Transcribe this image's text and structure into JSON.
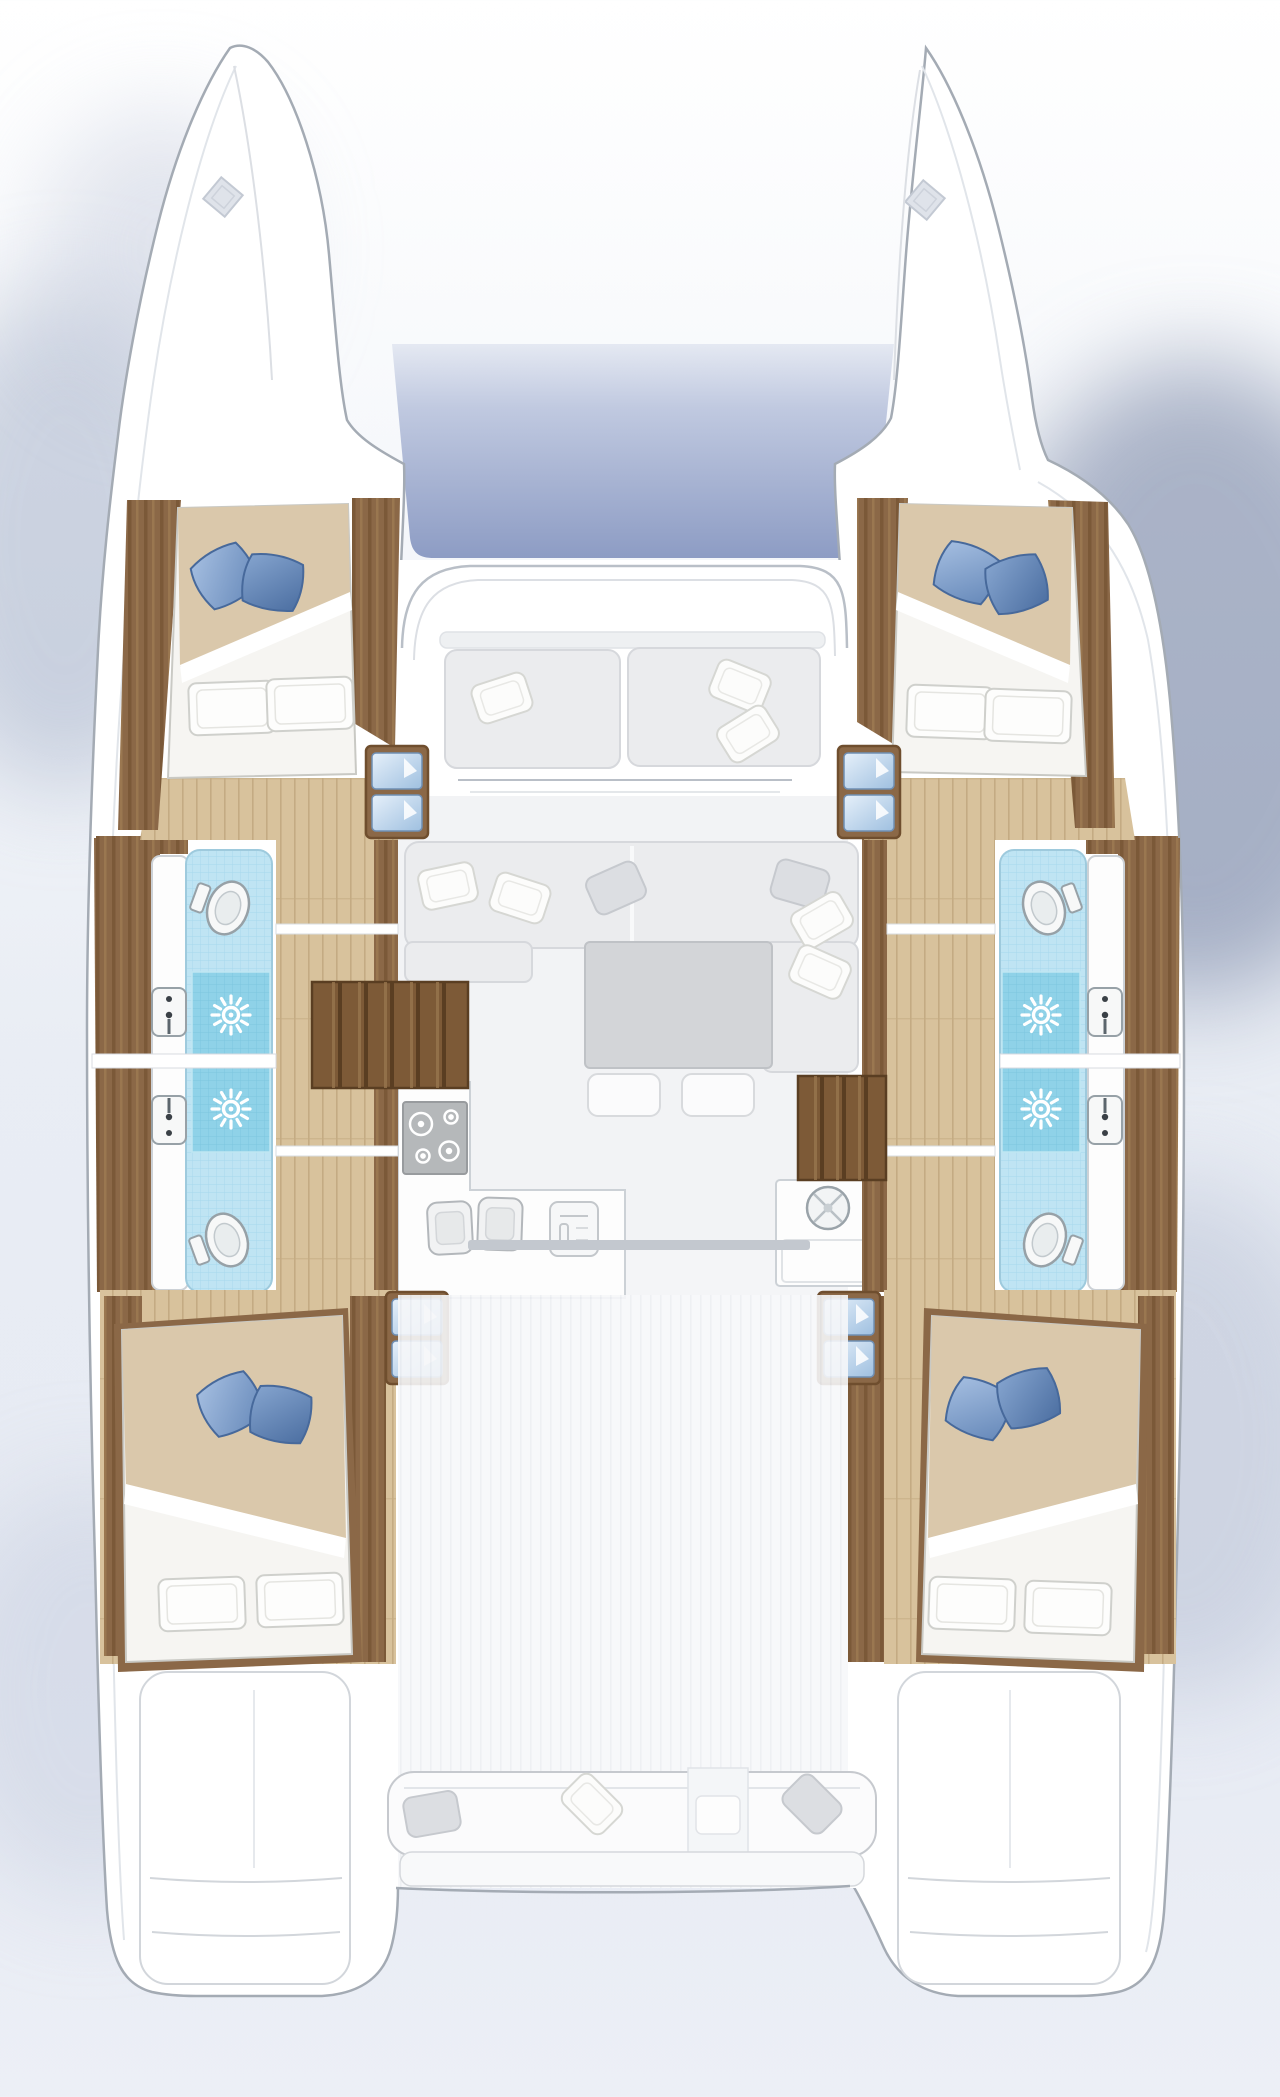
{
  "palette": {
    "hull_fill": "#ffffff",
    "hull_stroke": "#a4abb4",
    "sheer_line": "#e1e5ea",
    "deck_line": "#b9bfc7",
    "deck_line_soft": "#dcdfe4",
    "deck_stripe": "#eceef2",
    "deck_base": "#f6f7f9",
    "tramp_top": "#c0c9e0",
    "tramp_bottom": "#8d9cc4",
    "wood": "#8b6847",
    "wood_dark": "#6f4e2e",
    "wood_light": "#a68257",
    "floor": "#d8c29c",
    "floor_line": "#c4ab83",
    "stair": "#7d5a37",
    "stair_dark": "#5a3e22",
    "stair_light": "#97764e",
    "tread_light": "#e6f0fa",
    "tread_dark": "#9fc0e0",
    "tread_stroke": "#6f8fb4",
    "tile": "#bfe4f3",
    "tile_line": "#a6d8ec",
    "tile_dark": "#8fd2e8",
    "tile_dark_line": "#7cc6de",
    "tile_stroke": "#9ecadd",
    "fixture_white": "#f7f8f8",
    "fixture_stroke": "#97a1a7",
    "fixture_inner": "#e9edee",
    "counter": "#fdfdfd",
    "counter_stroke": "#ccd1d6",
    "stove": "#b5b8ba",
    "stove_stroke": "#989b9e",
    "sofa": "#ebecee",
    "sofa_stroke": "#d6d8dc",
    "table": "#d3d5d8",
    "table_stroke": "#bfc2c6",
    "cushion": "#fbfbfc",
    "cushion_stroke": "#d8dadd",
    "pillow_white": "#fcfcfb",
    "pillow_white_stroke": "#d6d7d3",
    "pillow_gray": "#dcdee2",
    "pillow_gray_stroke": "#c6c9ce",
    "pillow_blue_a1": "#a7c0e2",
    "pillow_blue_a2": "#6487b8",
    "pillow_blue_b1": "#87a6d0",
    "pillow_blue_b2": "#4a6da0",
    "pillow_blue_stroke": "#47699b",
    "bed_sheet": "#f6f5f2",
    "bed_sheet_stroke": "#c9c9c4",
    "duvet": "#dac8ab",
    "bed_pillow": "#fdfdfc",
    "bed_pillow_stroke": "#cfd0cc",
    "door_track": "#c3c8cf",
    "white": "#ffffff"
  },
  "icons": {
    "toilet-icon": "oval toilet seen from above",
    "shower-icon": "sunburst shower drain on dark tile",
    "sink-icon": "rectangular basin with faucet",
    "stove-icon": "four-burner cooktop",
    "galley-sink-icon": "double basin sink",
    "fridge-icon": "front-opening appliance",
    "bar-sink-icon": "round basin with cross handles",
    "hatch-icon": "square deck hatch rotated 45deg",
    "entry-steps-icon": "two blue-cushioned companionway steps",
    "stairs-icon": "slatted wooden stair run"
  },
  "inventory": {
    "forward_cabins": 2,
    "aft_cabins": 2,
    "bathrooms": 4,
    "showers": 4,
    "toilets": 4,
    "bathroom_sinks": 4,
    "double_beds": 4,
    "salon_tables": 1,
    "cockpit_benches": 2,
    "trampolines": 1
  }
}
